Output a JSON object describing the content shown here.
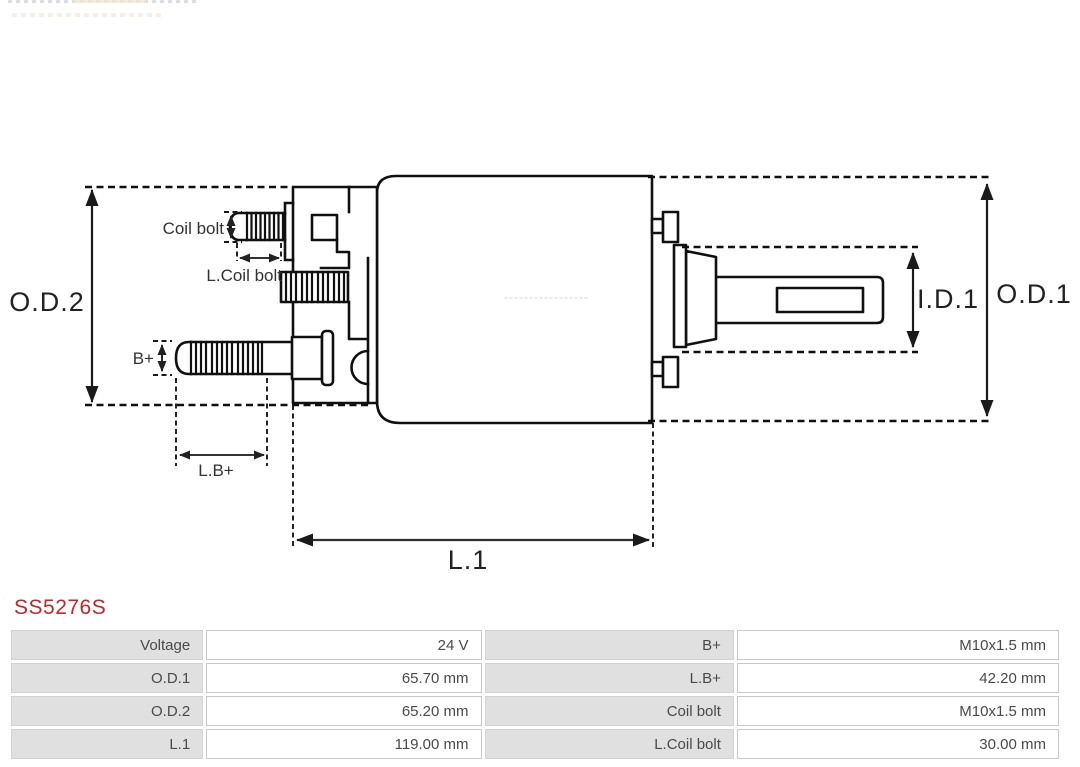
{
  "part_number": {
    "text": "SS5276S"
  },
  "diagram": {
    "labels": {
      "od2": "O.D.2",
      "od1": "O.D.1",
      "id1": "I.D.1",
      "l1": "L.1",
      "coil_bolt": "Coil bolt",
      "l_coil_bolt": "L.Coil bolt",
      "b_plus": "B+",
      "l_b_plus": "L.B+"
    }
  },
  "spec_table": {
    "rows": [
      {
        "label1": "Voltage",
        "value1": "24 V",
        "label2": "B+",
        "value2": "M10x1.5 mm"
      },
      {
        "label1": "O.D.1",
        "value1": "65.70 mm",
        "label2": "L.B+",
        "value2": "42.20 mm"
      },
      {
        "label1": "O.D.2",
        "value1": "65.20 mm",
        "label2": "Coil bolt",
        "value2": "M10x1.5 mm"
      },
      {
        "label1": "L.1",
        "value1": "119.00 mm",
        "label2": "L.Coil bolt",
        "value2": "30.00 mm"
      }
    ]
  },
  "colors": {
    "part_number_red": "#c4252c",
    "table_label_bg": "#e0e0e0",
    "table_border": "#c9c9c9",
    "drawing_line": "#101010"
  }
}
